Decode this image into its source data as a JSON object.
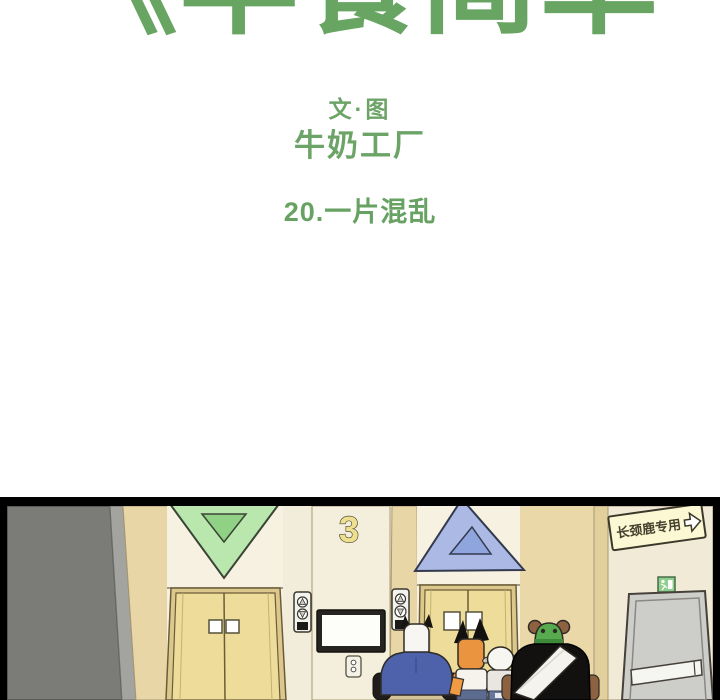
{
  "header": {
    "series_title_partial": "《早餐简单",
    "credit_label": "文·图",
    "author": "牛奶工厂",
    "chapter_title": "20.一片混乱",
    "text_color": "#68a563"
  },
  "panel": {
    "floor_number": "3",
    "giraffe_sign_text": "长颈鹿专用",
    "elevator_left_indicator": "down-triangle",
    "elevator_right_indicator": "up-triangle",
    "characters": [
      "ox-in-blue-shirt",
      "fox-eared-girl",
      "sheep",
      "bear-with-green-cap"
    ],
    "colors": {
      "wall_cream": "#f2ecdb",
      "wall_tan": "#ead8a8",
      "wall_gray": "#7b7b78",
      "door_yellow": "#eedd9a",
      "triangle_down_green": "#b9e7ae",
      "triangle_up_blue": "#abb9e4",
      "sign_yellow": "#fcf8d4",
      "exit_door_gray": "#cdcdca",
      "shirt_blue": "#4d62aa",
      "bear_black": "#131110",
      "outline": "#2e2b27"
    }
  }
}
